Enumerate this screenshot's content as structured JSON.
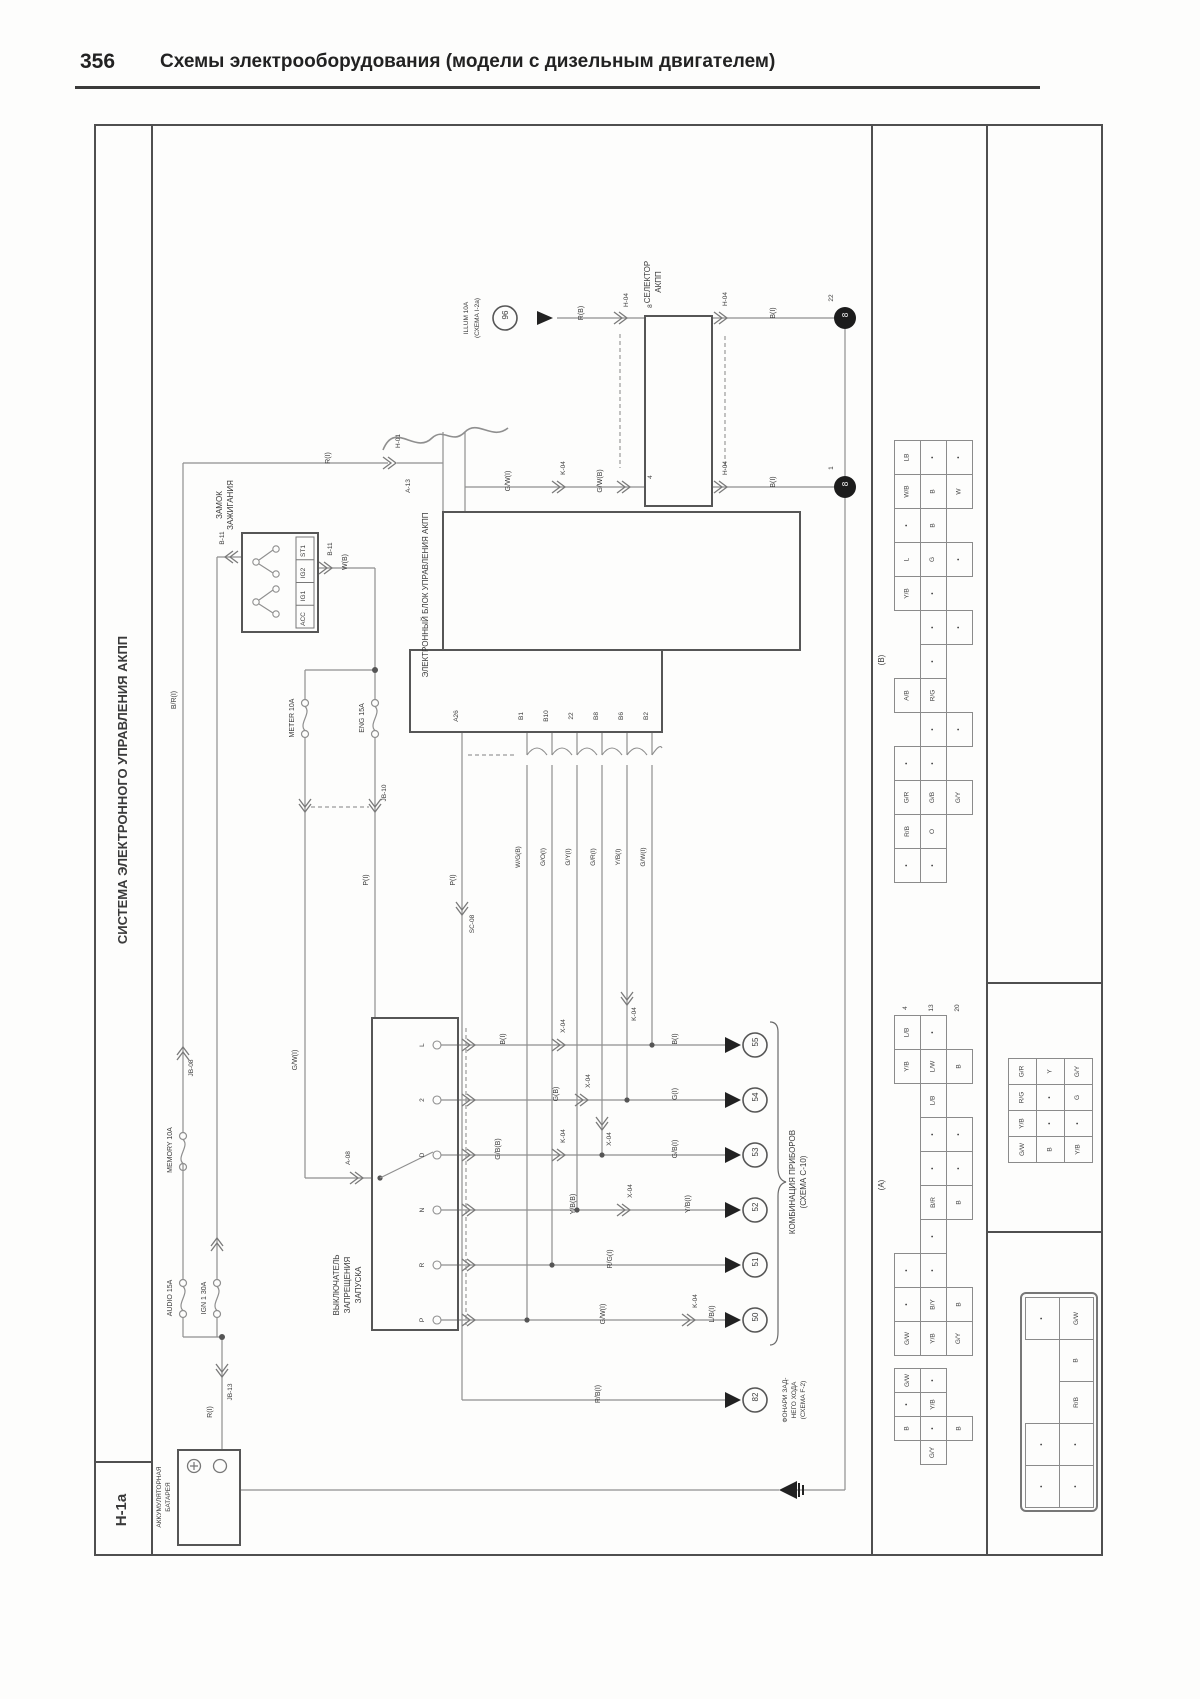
{
  "page": {
    "number": "356",
    "title": "Схемы электрооборудования (модели с дизельным двигателем)"
  },
  "diagram": {
    "code": "H-1a",
    "system_title": "СИСТЕМА ЭЛЕКТРОННОГО УПРАВЛЕНИЯ АКПП",
    "components": {
      "battery_l1": "АККУМУЛЯТОРНАЯ",
      "battery_l2": "БАТАРЕЯ",
      "ignition_l1": "ЗАМОК",
      "ignition_l2": "ЗАЖИГАНИЯ",
      "ecu": "ЭЛЕКТРОННЫЙ БЛОК УПРАВЛЕНИЯ АКПП",
      "selector_l1": "СЕЛЕКТОР",
      "selector_l2": "АКПП",
      "inhibitor_l1": "ВЫКЛЮЧАТЕЛЬ",
      "inhibitor_l2": "ЗАПРЕЩЕНИЯ",
      "inhibitor_l3": "ЗАПУСКА",
      "combo_l1": "КОМБИНАЦИЯ ПРИБОРОВ",
      "combo_l2": "(СХЕМА C-10)",
      "reverse_l1": "ФОНАРИ ЗАД-",
      "reverse_l2": "НЕГО ХОДА",
      "reverse_l3": "(СХЕМА F-2)",
      "illum_l1": "ILLUM 10A",
      "illum_l2": "(СХЕМА I-2a)"
    },
    "fuses": {
      "audio": "AUDIO 15A",
      "ign1": "IGN 1 30A",
      "memory": "MEMORY 10A",
      "meter": "METER 10A",
      "eng": "ENG 15A"
    },
    "terms": [
      "ST1",
      "IG2",
      "IG1",
      "ACC"
    ],
    "positions": [
      "L",
      "2",
      "D",
      "N",
      "R",
      "P"
    ],
    "cn": {
      "h01": "H-01",
      "h04": "H-04",
      "b11": "B-11",
      "a08": "A-08",
      "a13": "A-13",
      "k04": "K-04",
      "x04": "X-04",
      "sc08": "SC-08",
      "jb08": "JB-08",
      "jb13": "JB-13",
      "jb10": "JB-10"
    },
    "w": {
      "rb": "R(B)",
      "ri": "R(I)",
      "bi": "B(I)",
      "bri": "B/R(I)",
      "wb": "W(B)",
      "gwi": "G/W(I)",
      "gwb": "G/W(B)",
      "pi": "P(I)",
      "gi": "G(I)",
      "gbb": "G/B(B)",
      "gbi": "G/B(I)",
      "ybi": "Y/B(I)",
      "ybb": "Y/B(B)",
      "rgi": "R/G(I)",
      "lbi": "L/B(I)",
      "rbi": "R/B(I)",
      "wgb": "W/G(B)",
      "goi": "G/O(I)",
      "gyi": "G/Y(I)",
      "gri": "G/R(I)",
      "gb2": "G(B)"
    },
    "pins": {
      "a26": "A26",
      "b1": "B1",
      "b10": "B10",
      "p22": "22",
      "b8": "B8",
      "b6": "B6",
      "b2": "B2",
      "n22": "22",
      "n1": "1",
      "n4": "4",
      "n8": "8",
      "n13": "13",
      "n20": "20"
    },
    "circles": {
      "c96": "96",
      "c8": "8",
      "c50": "50",
      "c51": "51",
      "c52": "52",
      "c53": "53",
      "c54": "54",
      "c55": "55",
      "c82": "82"
    },
    "tables": {
      "a_label": "(A)",
      "b_label": "(B)"
    },
    "grids": {
      "b": [
        [
          "LB",
          "•",
          "•"
        ],
        [
          "W/B",
          "B",
          "W"
        ],
        [
          "•",
          "B",
          null
        ],
        [
          "L",
          "G",
          "•"
        ],
        [
          "Y/B",
          "•",
          null
        ],
        [
          null,
          "•",
          "•"
        ],
        [
          null,
          "•",
          null
        ],
        [
          "A/B",
          "R/G",
          null
        ],
        [
          null,
          "•",
          "•"
        ],
        [
          "•",
          "•",
          null
        ],
        [
          "G/R",
          "G/B",
          "G/Y"
        ],
        [
          "R/B",
          "O",
          null
        ],
        [
          "•",
          "•",
          null
        ]
      ],
      "a": [
        [
          "L/B",
          "•",
          null
        ],
        [
          "Y/B",
          "L/W",
          "B"
        ],
        [
          null,
          "L/B",
          null
        ],
        [
          null,
          "•",
          "•"
        ],
        [
          null,
          "•",
          "•"
        ],
        [
          null,
          "B/R",
          "B"
        ],
        [
          null,
          "•",
          null
        ],
        [
          "•",
          "•",
          null
        ],
        [
          "•",
          "B/Y",
          "B"
        ],
        [
          "G/W",
          "Y/B",
          "G/Y"
        ]
      ],
      "m": [
        [
          "G/W",
          "•",
          null
        ],
        [
          "•",
          "Y/B",
          null
        ],
        [
          "B",
          "•",
          "B"
        ],
        [
          null,
          "G/Y",
          null
        ]
      ],
      "r": [
        [
          "G/R",
          "Y",
          "G/Y"
        ],
        [
          "R/G",
          "•",
          "G"
        ],
        [
          "Y/B",
          "•",
          "•"
        ],
        [
          "G/W",
          "B",
          "Y/B"
        ]
      ],
      "c": [
        [
          "•",
          "G/W"
        ],
        [
          null,
          "B"
        ],
        [
          null,
          "R/B"
        ],
        [
          "•",
          "•"
        ],
        [
          "•",
          "•"
        ]
      ]
    }
  }
}
